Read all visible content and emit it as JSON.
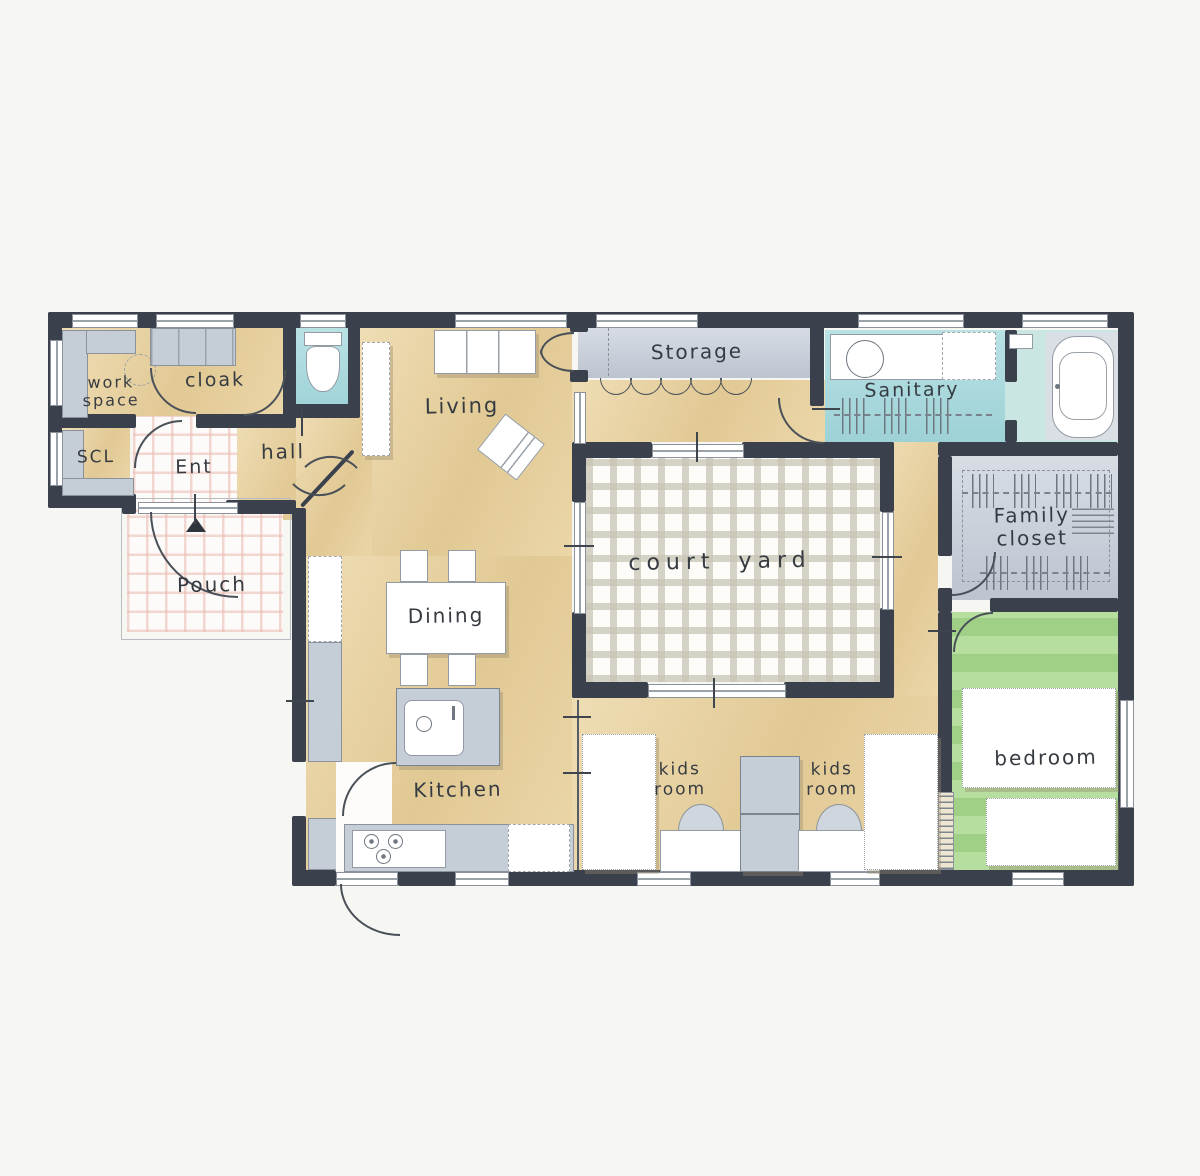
{
  "colors": {
    "background": "#f6f6f3",
    "wall": "#3a414c",
    "floor_wood": "#e8d19e",
    "floor_tile": "#a7dade",
    "floor_bath": "#c9e6e2",
    "floor_gray": "#c9d0da",
    "floor_green": "#a9d88f",
    "cabinet_gray": "#c5cdd7",
    "line": "#4a5058",
    "furniture_line": "#949ba4",
    "text": "#363b41"
  },
  "rooms": {
    "work_space": {
      "label": "work space"
    },
    "cloak": {
      "label": "cloak"
    },
    "scl": {
      "label": "SCL"
    },
    "ent": {
      "label": "Ent"
    },
    "hall": {
      "label": "hall"
    },
    "porch": {
      "label": "Pouch"
    },
    "living": {
      "label": "Living"
    },
    "storage": {
      "label": "Storage"
    },
    "sanitary": {
      "label": "Sanitary"
    },
    "family_closet": {
      "label": "Family closet"
    },
    "courtyard": {
      "label": "court yard"
    },
    "dining": {
      "label": "Dining"
    },
    "kitchen": {
      "label": "Kitchen"
    },
    "kids_room_1": {
      "label": "kids room"
    },
    "kids_room_2": {
      "label": "kids room"
    },
    "bedroom": {
      "label": "bedroom"
    }
  }
}
